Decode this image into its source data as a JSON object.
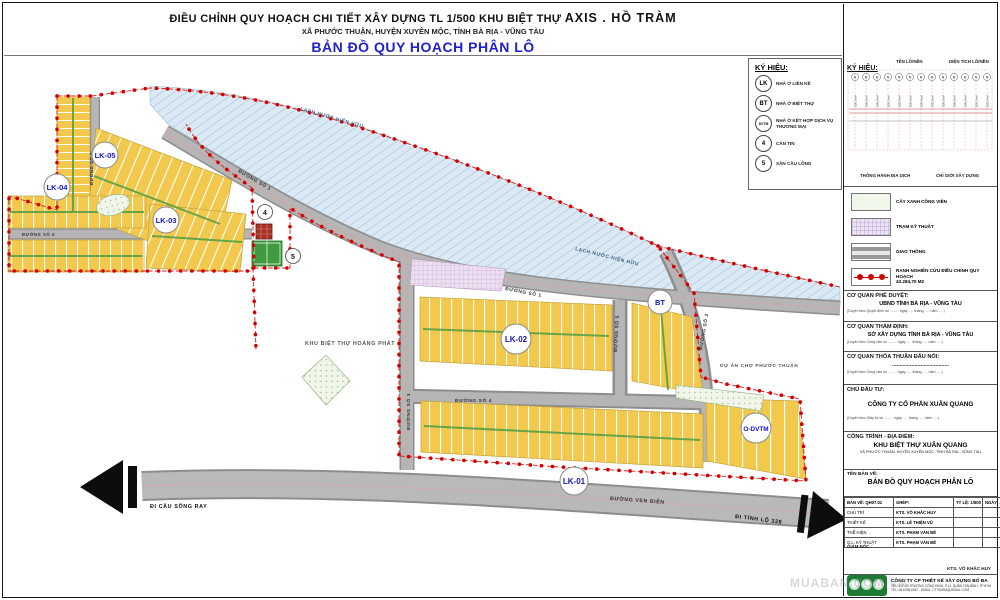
{
  "title": {
    "line1a": "ĐIỀU CHỈNH QUY HOẠCH CHI TIẾT XÂY DỰNG TL 1/500 KHU BIỆT THỰ",
    "line1b": "AXIS . HỒ TRÀM",
    "line2": "XÃ PHƯỚC THUẬN, HUYỆN XUYÊN MỘC, TỈNH BÀ RỊA - VŨNG TÀU",
    "line3": "BẢN ĐỒ QUY HOẠCH PHÂN LÔ"
  },
  "scale_box": {
    "north": "B",
    "top_ticks": [
      "0mm",
      "20mm",
      "40mm",
      "60mm",
      "80mm",
      "100mm"
    ],
    "bottom_ticks": [
      "0m",
      "10m",
      "20m",
      "30m",
      "40m",
      "50m"
    ],
    "label": "TỶ LỆ XÍCH"
  },
  "map_legend": {
    "title": "KÝ HIỆU:",
    "items": [
      {
        "symbol": "LK",
        "label": "NHÀ Ở LIÊN KẾ"
      },
      {
        "symbol": "BT",
        "label": "NHÀ Ở BIỆT THỰ"
      },
      {
        "symbol": "DVTM",
        "label": "NHÀ Ở KẾT HỢP DỊCH VỤ THƯƠNG MẠI"
      },
      {
        "symbol": "4",
        "label": "CĂN TIN"
      },
      {
        "symbol": "5",
        "label": "SÂN CẦU LÔNG"
      }
    ]
  },
  "right_panel": {
    "symbols_title": "KÝ HIỆU:",
    "lot_name_label": "TÊN LÔ/NỀN",
    "lot_area_label": "DIỆN TÍCH LÔ/NỀN",
    "lot_circle": "N",
    "lot_area_value": "100,0 m²",
    "easement_label": "THÔNG HÀNH ĐỊA DỊCH",
    "building_line_label": "CHỈ GIỚI XÂY DỰNG",
    "swatches": [
      {
        "label": "CÂY XANH CÔNG VIÊN",
        "label2": ""
      },
      {
        "label": "TRẠM KỸ THUẬT",
        "label2": ""
      },
      {
        "label": "GIAO THÔNG",
        "label2": ""
      },
      {
        "label": "RANH NGHIÊN CỨU ĐIỀU CHỈNH QUY HOẠCH",
        "label2": "43.284,70 M2"
      }
    ],
    "approvals": [
      {
        "heading": "CƠ QUAN PHÊ DUYỆT:",
        "name": "UBND TỈNH BÀ RỊA - VŨNG TÀU",
        "note": "(Duyệt theo Quyết định số ......... ngày ..... tháng ..... năm .....)"
      },
      {
        "heading": "CƠ QUAN THẨM ĐỊNH:",
        "name": "SỞ XÂY DỰNG TỈNH BÀ RỊA - VŨNG TÀU",
        "note": "(Duyệt theo Công văn số ......... ngày ..... tháng ..... năm .....)"
      },
      {
        "heading": "CƠ QUAN THỎA THUẬN ĐẤU NỐI:",
        "name": "......................................",
        "note": "(Duyệt theo Công văn số ......... ngày ..... tháng ..... năm .....)"
      },
      {
        "heading": "CHỦ ĐẦU TƯ:",
        "name": "CÔNG TY CỔ PHẦN XUÂN QUANG",
        "note": "(Duyệt theo Giấy tờ số ......... ngày ..... tháng ..... năm .....)"
      }
    ],
    "project": {
      "heading": "CÔNG TRÌNH - ĐỊA ĐIỂM:",
      "name": "KHU BIỆT THỰ XUÂN QUANG",
      "address": "XÃ PHƯỚC THUẬN, HUYỆN XUYÊN MỘC, TỈNH BÀ RỊA - VŨNG TÀU"
    },
    "drawing": {
      "heading": "TÊN BẢN VẼ:",
      "name": "BẢN ĐỒ QUY HOẠCH PHÂN LÔ",
      "sheet": "BẢN VẼ:  QH07.01",
      "merge": "GHÉP:",
      "scale": "TỶ LỆ:  1/500",
      "date": "NGÀY: ... - 02 - 2019",
      "roles": [
        {
          "role": "CHỦ TRÌ",
          "person": "KTS. VÕ KHẮC HUY"
        },
        {
          "role": "THIẾT KẾ",
          "person": "KTS. LÊ THIỆN VŨ"
        },
        {
          "role": "THỂ HIỆN",
          "person": "KTS. PHẠM VĂN ĐẾ"
        },
        {
          "role": "Q.L. KỸ THUẬT",
          "person": "KTS. PHẠM VĂN ĐẾ"
        }
      ],
      "director_label": "GIÁM ĐỐC",
      "director": "KTS. VÕ KHẮC HUY"
    },
    "company": {
      "name": "CÔNG TY CP THIẾT KẾ XÂY DỰNG BỐ BA",
      "addr1": "TRỤ SỞ: 49 TRƯƠNG CÔNG ĐỊNH, P.14, QUẬN TÂN BÌNH, TP.HCM",
      "addr2": "TEL: 08.6296.6367  -  EMAIL: CTYBOBA@GMAIL.COM",
      "logo_caption": "CTY CP TKXD BỐ BA"
    }
  },
  "map": {
    "water": "LẠCH NƯỚC HIỆN HỮU",
    "road_1": "ĐƯỜNG SỐ 1",
    "road_2": "ĐƯỜNG SỐ 2",
    "road_3": "ĐƯỜNG SỐ 3",
    "road_4": "ĐƯỜNG SỐ 4",
    "road_5": "ĐƯỜNG SỐ 5",
    "road_6": "ĐƯỜNG SỐ 6",
    "road_9": "ĐƯỜNG SỐ 9",
    "ven_bien": "ĐƯỜNG VEN BIỂN",
    "zones": {
      "lk01": "LK-01",
      "lk02": "LK-02",
      "lk03": "LK-03",
      "lk04": "LK-04",
      "lk05": "LK-05",
      "bt": "BT",
      "dvtm": "O-DVTM"
    },
    "canteen_num": "4",
    "court_num": "5",
    "hoang_phat": "KHU BIỆT THỰ HOÀNG PHÁT",
    "cho_phuoc_thuan": "DỰ ÁN CHỢ PHƯỚC THUẬN",
    "exit_left": "ĐI CẦU SÔNG RAY",
    "exit_right": "ĐI TỈNH LỘ 328"
  },
  "watermark": "MUABAN.COM.VN",
  "colors": {
    "lot_yellow": "#F2C94C",
    "boundary_red": "#D91A1A",
    "road_gray": "#B5B5B5",
    "water_blue": "#DBE9F4",
    "title_blue": "#2020CC"
  }
}
